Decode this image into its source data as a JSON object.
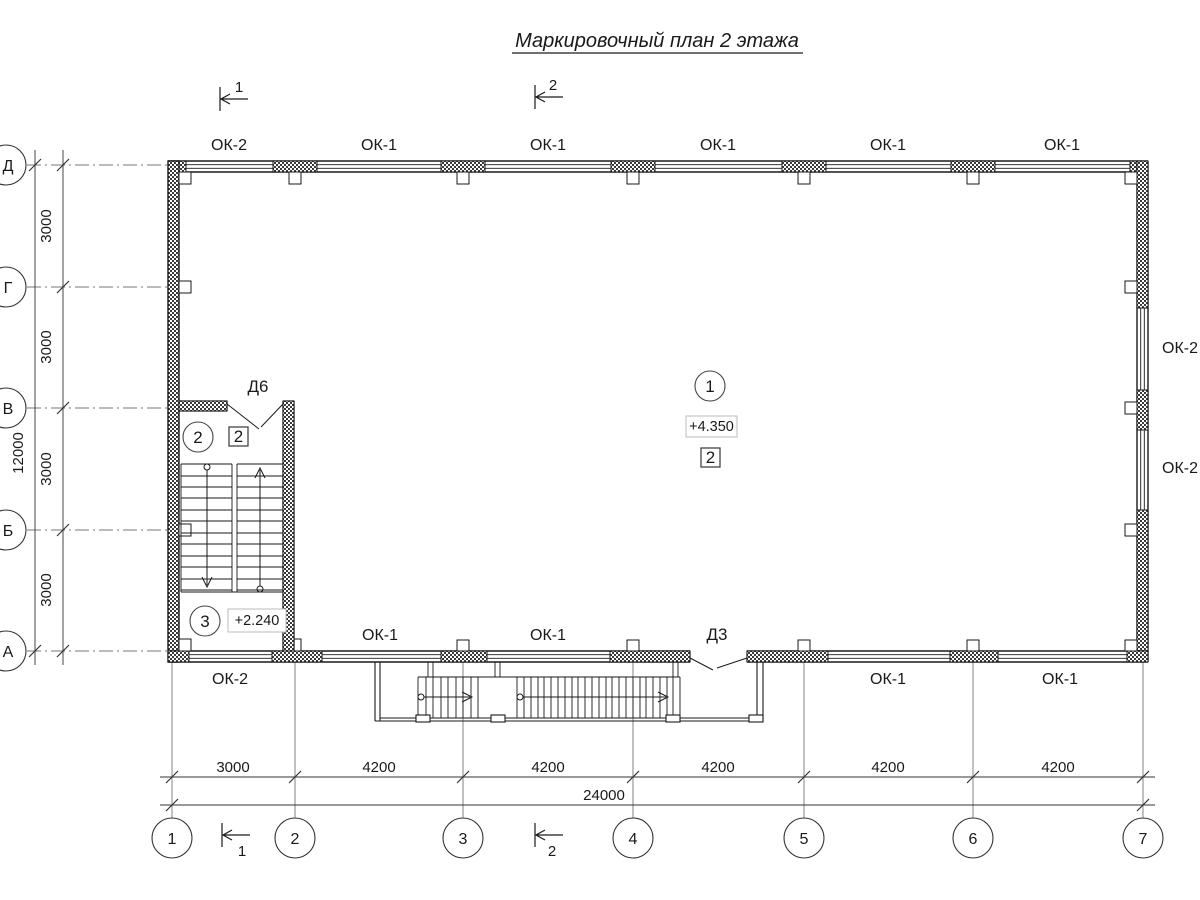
{
  "title": "Маркировочный план 2 этажа",
  "colors": {
    "ink": "#1a1a1a",
    "background": "#ffffff"
  },
  "section_markers": {
    "top_1": "1",
    "top_2": "2",
    "bottom_1": "1",
    "bottom_2": "2"
  },
  "windows": {
    "top": [
      "ОК-2",
      "ОК-1",
      "ОК-1",
      "ОК-1",
      "ОК-1",
      "ОК-1"
    ],
    "right": [
      "ОК-2",
      "ОК-2"
    ],
    "bottom_left": "ОК-2",
    "bottom_above": [
      "ОК-1",
      "ОК-1"
    ],
    "bottom_right": [
      "ОК-1",
      "ОК-1"
    ]
  },
  "doors": {
    "stair_door": "Д6",
    "entrance_door": "Д3"
  },
  "rooms": {
    "hall": {
      "number": "1",
      "elevation": "+4.350",
      "type_mark": "2"
    },
    "stair_upper": {
      "number": "2",
      "type_mark": "2"
    },
    "stair_lower": {
      "number": "3",
      "elevation": "+2.240"
    }
  },
  "axes": {
    "horizontal": [
      "1",
      "2",
      "3",
      "4",
      "5",
      "6",
      "7"
    ],
    "vertical": [
      "Д",
      "Г",
      "В",
      "Б",
      "А"
    ]
  },
  "dimensions": {
    "bottom_segments": [
      "3000",
      "4200",
      "4200",
      "4200",
      "4200",
      "4200"
    ],
    "bottom_total": "24000",
    "left_segments": [
      "3000",
      "3000",
      "3000",
      "3000"
    ],
    "left_total": "12000"
  }
}
